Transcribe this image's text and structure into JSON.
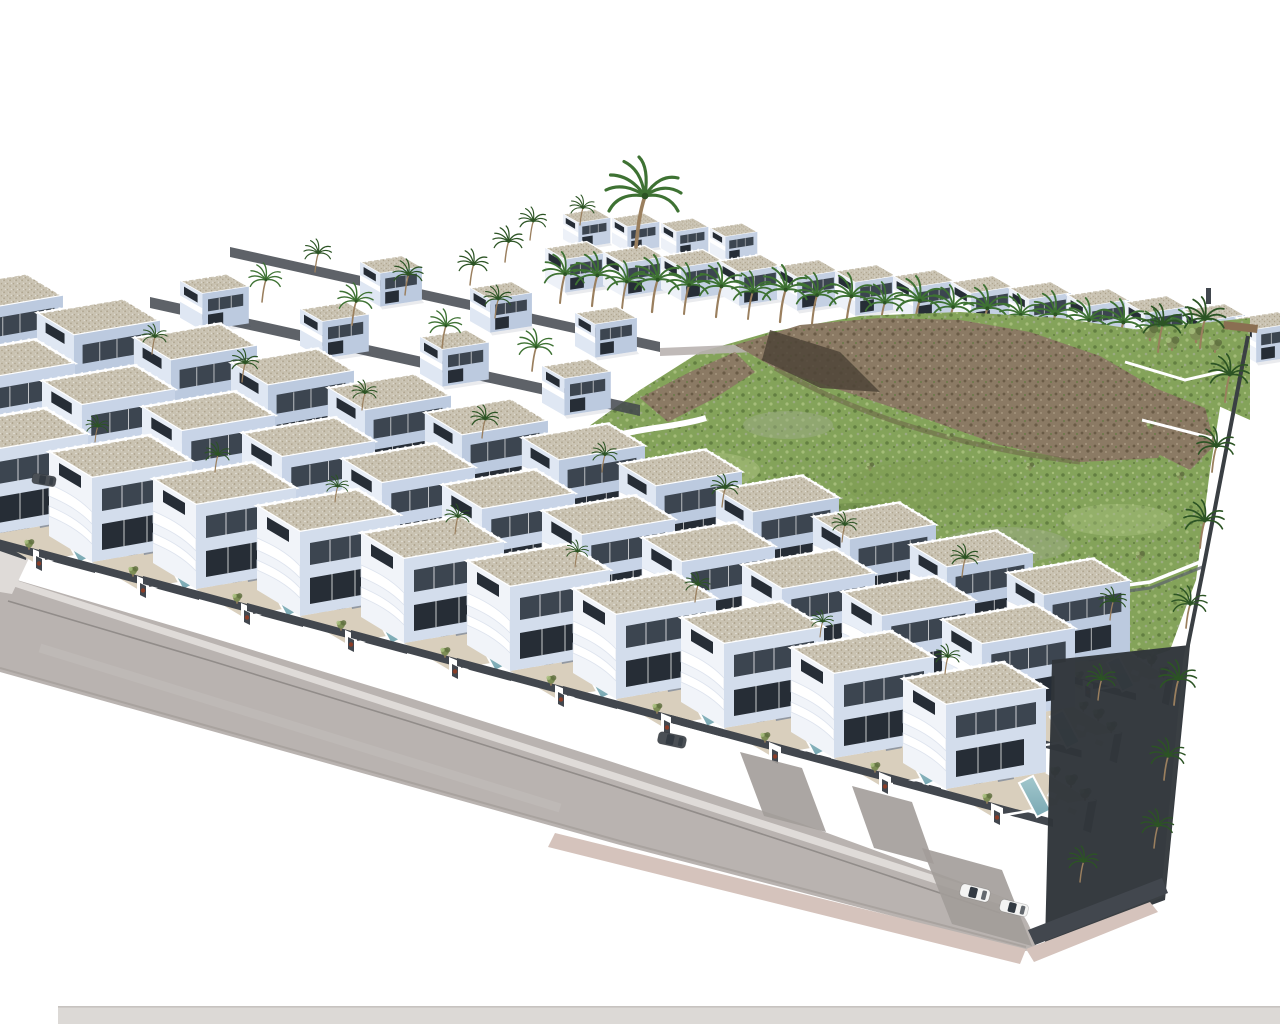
{
  "scene": {
    "description": "Aerial 3D architectural rendering of a hillside residential development: terraced rows of white modern villas with rooftop terraces, curved balcony parapets, private pools and palm-lined gardens face a curved perimeter road; additional villa rows sit above, with a green hillside and brown volcanic rock outcrops at the upper right, dark boundary hedges on the right edge and a few parked cars near the lower corner.",
    "setting": "sunny coastal estate render on a plain white background",
    "element_labels": [
      "villa",
      "rooftop terrace",
      "swimming pool",
      "entry portal",
      "garden wall",
      "palm tree",
      "olive shrub",
      "hillside scrub",
      "rock outcrop",
      "perimeter road",
      "sidewalk",
      "driveway",
      "parked car",
      "boundary hedge",
      "retaining wall"
    ],
    "approx_counts": {
      "villa_rows": 6,
      "villas": 53,
      "pools": 33,
      "palm_trees": 55,
      "parked_cars": 4
    }
  },
  "colors": {
    "background": "#ffffff",
    "white": "#ffffff",
    "villa_face": "#f1f4f9",
    "villa_side": "#d3ddec",
    "villa_face_mid": "#e8eef7",
    "villa_side_mid": "#c8d4e7",
    "villa_face_back": "#dfe7f3",
    "villa_side_back": "#bccadf",
    "villa_face_top": "#edf1f8",
    "villa_side_top": "#c4d0e3",
    "roof": "#c9c2b1",
    "roof_speck": "#a99e87",
    "win": "#3c4550",
    "win_deep": "#262d36",
    "wall_dark": "#42474e",
    "wall_mid": "#5f656c",
    "terrace": "#d9cfbd",
    "pool_light": "#a3c8cd",
    "pool_deep": "#79a8b3",
    "road": "#b9b3b0",
    "road_dark": "#a29c99",
    "road_line": "#8a8583",
    "curb": "#dfdbd8",
    "sidewalk": "#d5c3bc",
    "bottom_strip": "#dcd9d6",
    "strip_line": "#c7c3c0",
    "grass": "#84a35a",
    "grass_light": "#a9c07e",
    "grass_sage": "#9cab85",
    "grass_dark": "#5e7a3e",
    "grass_mid": "#7b9850",
    "rock": "#8b7a64",
    "rock_dark": "#6a5b46",
    "rock_light": "#a4947d",
    "rock_shadow": "#4e4437",
    "palm": "#3e7233",
    "palm_dark": "#2c5424",
    "trunk": "#9a7f5e",
    "olive": "#7d8d55",
    "olive_dark": "#5f7040",
    "accent_plant": "#8a3d27",
    "furniture": "#9298a1",
    "car_white": "#f4f4f3",
    "car_dark": "#4a4f55",
    "car_glass": "#333a42",
    "fence": "#3a3f43",
    "hedge_dark": "#2f353a",
    "wood": "#8a6f52",
    "shadow": "rgba(45,60,85,0.10)"
  }
}
